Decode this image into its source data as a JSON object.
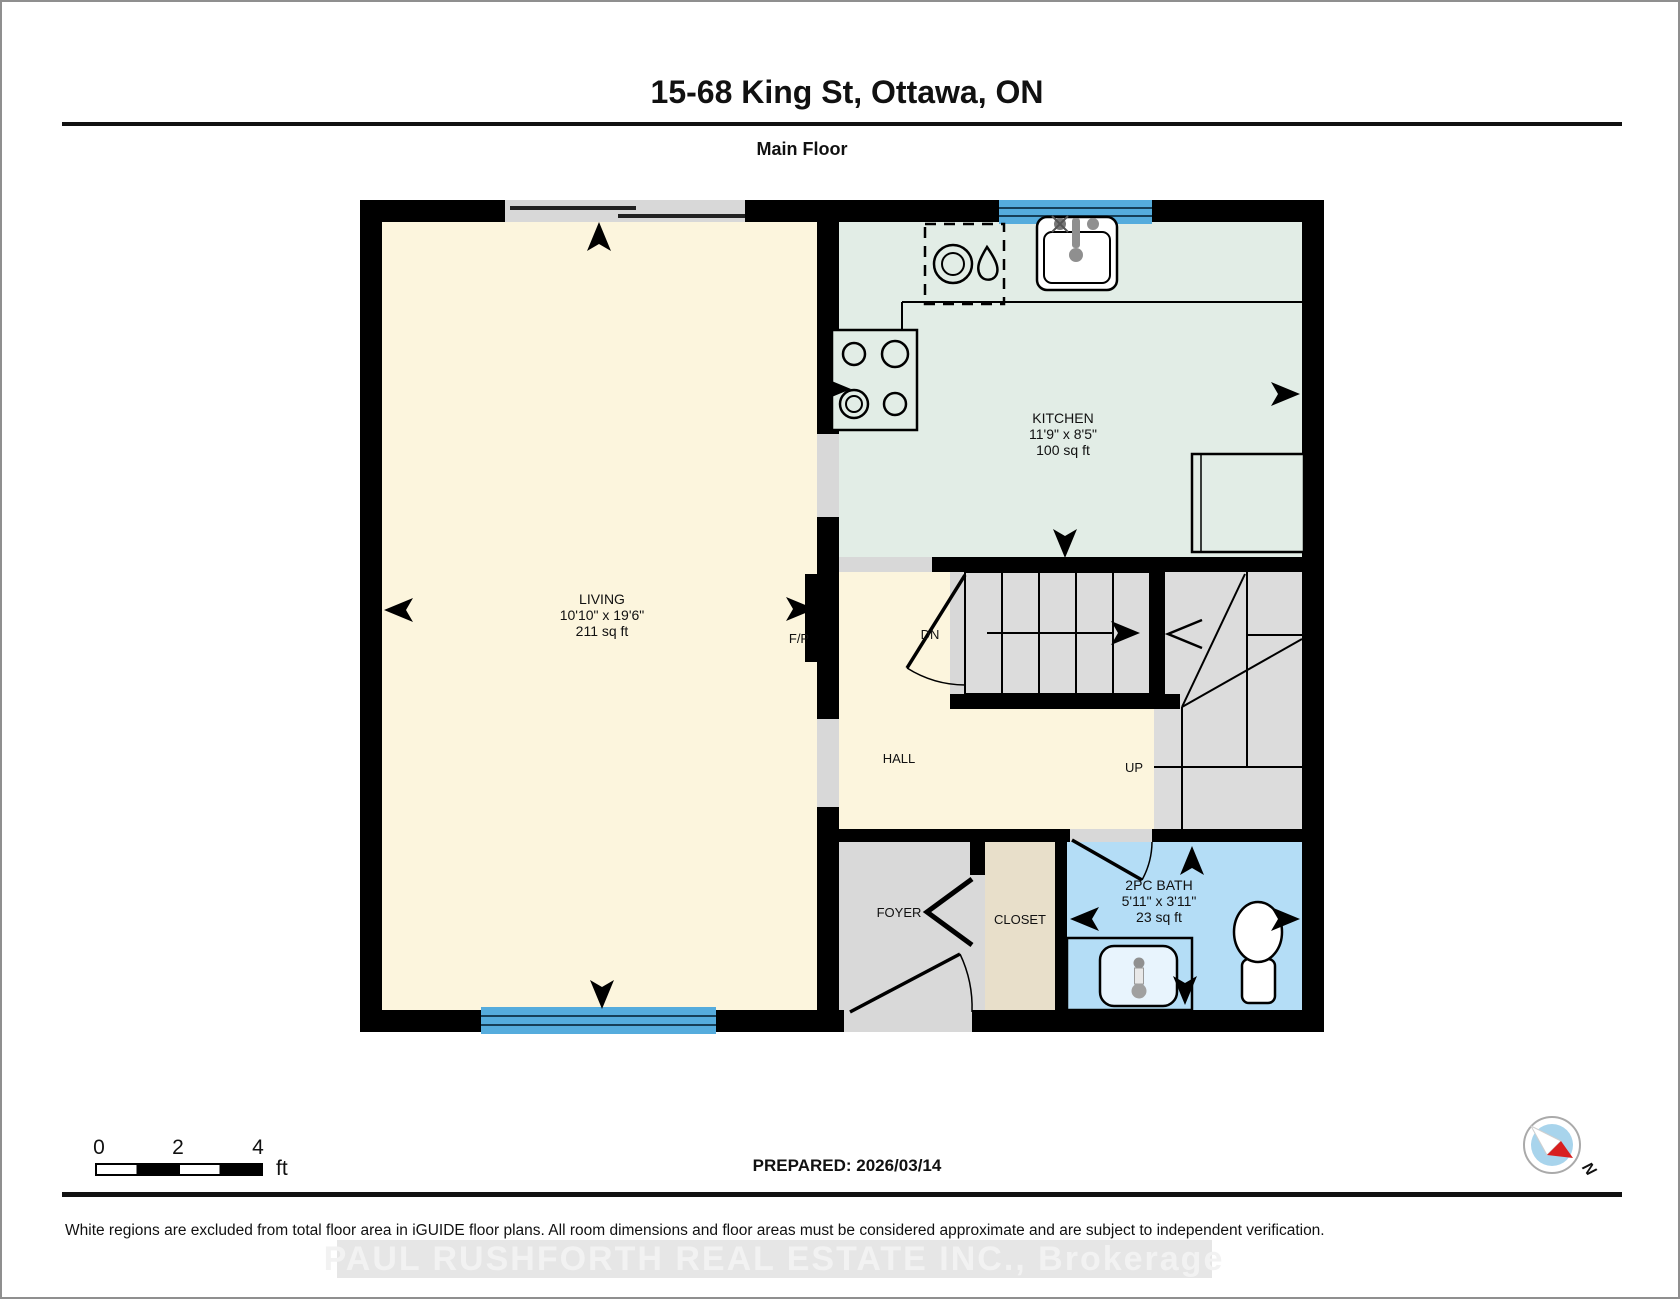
{
  "header": {
    "title": "15-68 King St, Ottawa, ON",
    "subtitle": "Main Floor"
  },
  "rooms": {
    "living": {
      "name": "LIVING",
      "dims": "10'10\" x 19'6\"",
      "area": "211 sq ft"
    },
    "kitchen": {
      "name": "KITCHEN",
      "dims": "11'9\" x 8'5\"",
      "area": "100 sq ft"
    },
    "bath": {
      "name": "2PC BATH",
      "dims": "5'11\" x 3'11\"",
      "area": "23 sq ft"
    },
    "hall": {
      "name": "HALL"
    },
    "foyer": {
      "name": "FOYER"
    },
    "closet": {
      "name": "CLOSET"
    }
  },
  "labels": {
    "stairs_down": "DN",
    "stairs_up": "UP",
    "fireplace": "F/P"
  },
  "scale_bar": {
    "tick0": "0",
    "tick2": "2",
    "tick4": "4",
    "unit": "ft"
  },
  "footer": {
    "prepared": "PREPARED: 2026/03/14",
    "disclaimer": "White regions are excluded from total floor area in iGUIDE floor plans. All room dimensions and floor areas must be considered approximate and are subject to independent verification.",
    "watermark": "PAUL RUSHFORTH REAL ESTATE INC., Brokerage"
  },
  "compass": {
    "north_label": "N"
  },
  "colors": {
    "wall": "#000000",
    "living_floor": "#fcf5dd",
    "kitchen_floor": "#e2ede6",
    "bath_floor": "#b4ddf6",
    "foyer_floor": "#d9d9d9",
    "closet_floor": "#e8dfca",
    "stairs_floor": "#dcdcdc",
    "window": "#55acdd",
    "opening": "#d8d8d8",
    "compass_blue": "#a8d4ec",
    "compass_red": "#d81f1f"
  }
}
